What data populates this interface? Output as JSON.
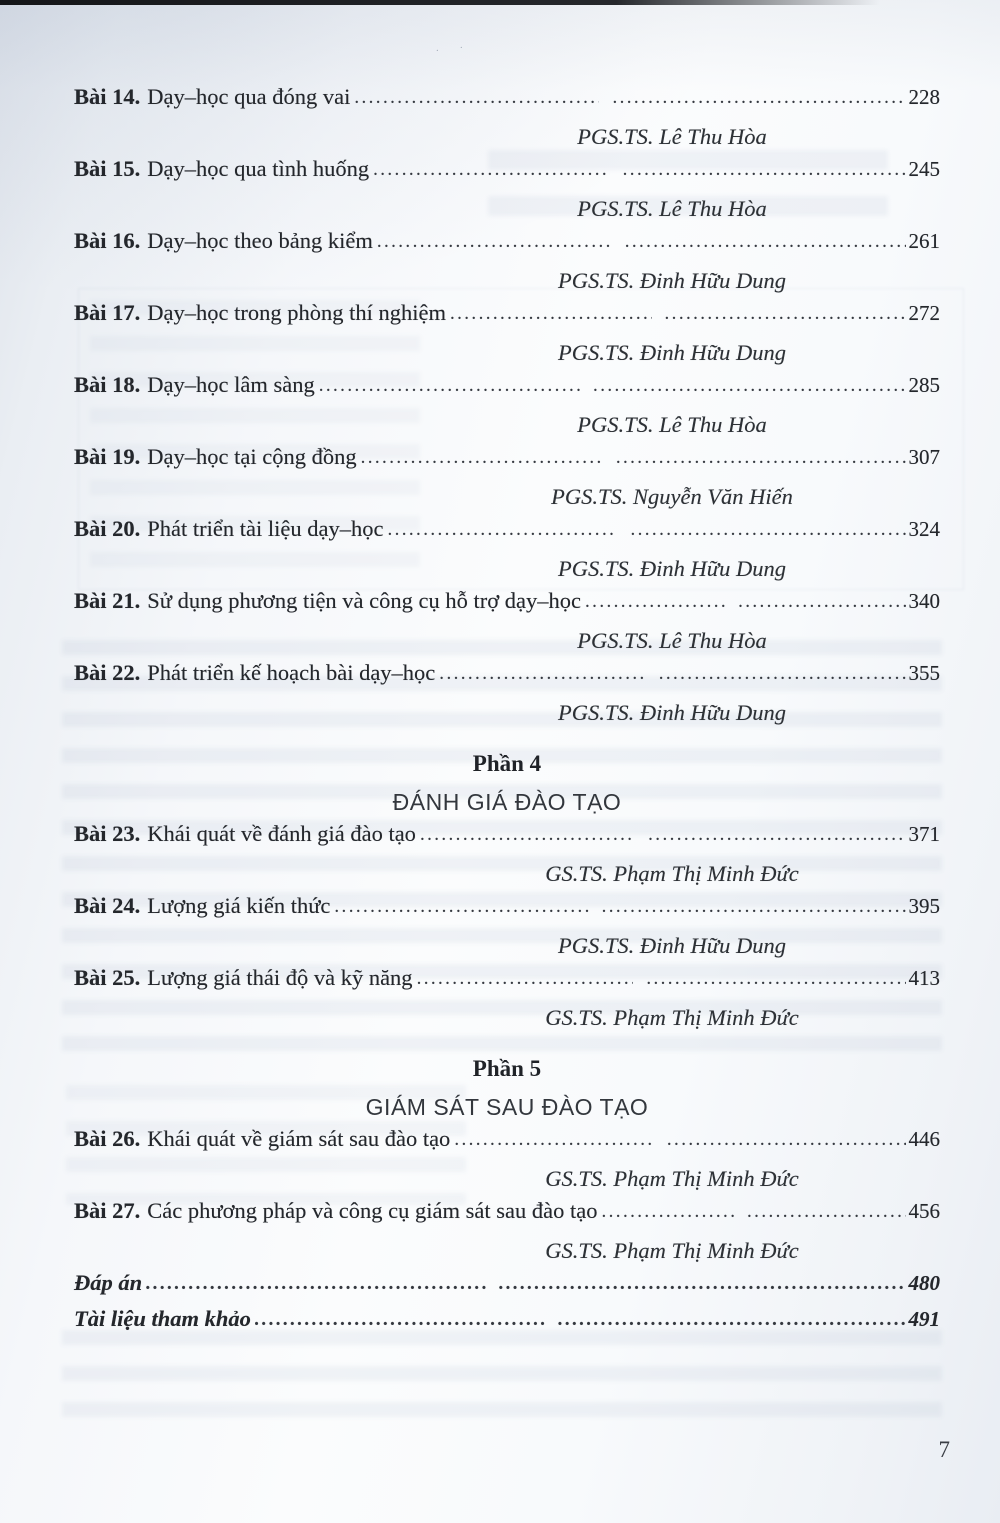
{
  "page_number": "7",
  "toc": {
    "sections": [
      {
        "type": "entries",
        "items": [
          {
            "label": "Bài 14.",
            "title": "Dạy–học qua đóng vai",
            "page": "228",
            "author": "PGS.TS. Lê Thu Hòa"
          },
          {
            "label": "Bài 15.",
            "title": "Dạy–học qua tình huống",
            "page": "245",
            "author": "PGS.TS. Lê Thu Hòa"
          },
          {
            "label": "Bài 16.",
            "title": "Dạy–học theo bảng kiểm",
            "page": "261",
            "author": "PGS.TS. Đinh Hữu Dung"
          },
          {
            "label": "Bài 17.",
            "title": "Dạy–học trong phòng thí nghiệm",
            "page": "272",
            "author": "PGS.TS. Đinh Hữu Dung"
          },
          {
            "label": "Bài 18.",
            "title": "Dạy–học lâm sàng",
            "page": "285",
            "author": "PGS.TS. Lê Thu Hòa"
          },
          {
            "label": "Bài 19.",
            "title": "Dạy–học tại cộng đồng",
            "page": "307",
            "author": "PGS.TS. Nguyễn Văn Hiến"
          },
          {
            "label": "Bài 20.",
            "title": "Phát triển tài liệu dạy–học",
            "page": "324",
            "author": "PGS.TS. Đinh Hữu Dung"
          },
          {
            "label": "Bài 21.",
            "title": "Sử dụng phương tiện và công cụ hỗ trợ dạy–học",
            "page": "340",
            "author": "PGS.TS. Lê Thu Hòa"
          },
          {
            "label": "Bài 22.",
            "title": "Phát triển kế hoạch bài dạy–học",
            "page": "355",
            "author": "PGS.TS. Đinh Hữu Dung"
          }
        ]
      },
      {
        "type": "part",
        "label": "Phần 4",
        "title": "ĐÁNH GIÁ ĐÀO TẠO"
      },
      {
        "type": "entries",
        "items": [
          {
            "label": "Bài 23.",
            "title": "Khái quát về đánh giá đào tạo",
            "page": "371",
            "author": "GS.TS. Phạm Thị Minh Đức"
          },
          {
            "label": "Bài 24.",
            "title": "Lượng giá kiến thức",
            "page": "395",
            "author": "PGS.TS. Đinh Hữu Dung"
          },
          {
            "label": "Bài 25.",
            "title": "Lượng giá thái độ và kỹ năng",
            "page": "413",
            "author": "GS.TS. Phạm Thị Minh Đức"
          }
        ]
      },
      {
        "type": "part",
        "label": "Phần 5",
        "title": "GIÁM SÁT SAU ĐÀO TẠO"
      },
      {
        "type": "entries",
        "items": [
          {
            "label": "Bài 26.",
            "title": "Khái quát về giám sát sau đào tạo",
            "page": "446",
            "author": "GS.TS. Phạm Thị Minh Đức"
          },
          {
            "label": "Bài 27.",
            "title": "Các phương pháp và công cụ giám sát sau đào tạo",
            "page": "456",
            "author": "GS.TS. Phạm Thị Minh Đức"
          }
        ]
      },
      {
        "type": "backmatter",
        "items": [
          {
            "title": "Đáp án",
            "page": "480"
          },
          {
            "title": "Tài liệu tham khảo",
            "page": "491"
          }
        ]
      }
    ]
  }
}
